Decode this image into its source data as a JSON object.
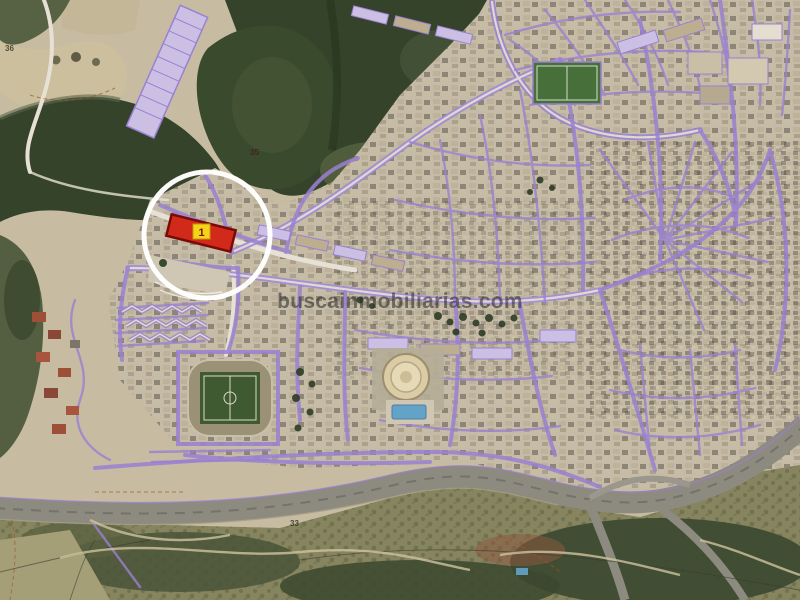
{
  "watermark": {
    "text": "buscainmobiliarias.com"
  },
  "marker": {
    "label": "1"
  },
  "map_labels": {
    "parcel_36": "36",
    "hill_35": "35",
    "road_33": "33"
  },
  "colors": {
    "base-tan": "#c7bca2",
    "field-light": "#cbbf9e",
    "forest-dark": "#35432b",
    "forest-mid": "#4a573a",
    "olive": "#87855f",
    "scrub-dark": "#3e4a30",
    "road-white": "#e6e1d4",
    "purple": "#9a81d2",
    "lavender": "#cbc0e4",
    "highway-gray": "#8d8a80",
    "pitch-green": "#3f5a31",
    "sportfield-green": "#476f3a",
    "bullring-sand": "#dbcca6",
    "pool-blue": "#64a3c8",
    "parcel-red": "#d22a1a",
    "parcel-border": "#7a0a06",
    "label-yellow": "#f2d419",
    "marker-white": "#ffffff",
    "watermark-gray": "#2f2f2f",
    "redroof": "#9e4f38",
    "contour-red": "#a5542e"
  }
}
